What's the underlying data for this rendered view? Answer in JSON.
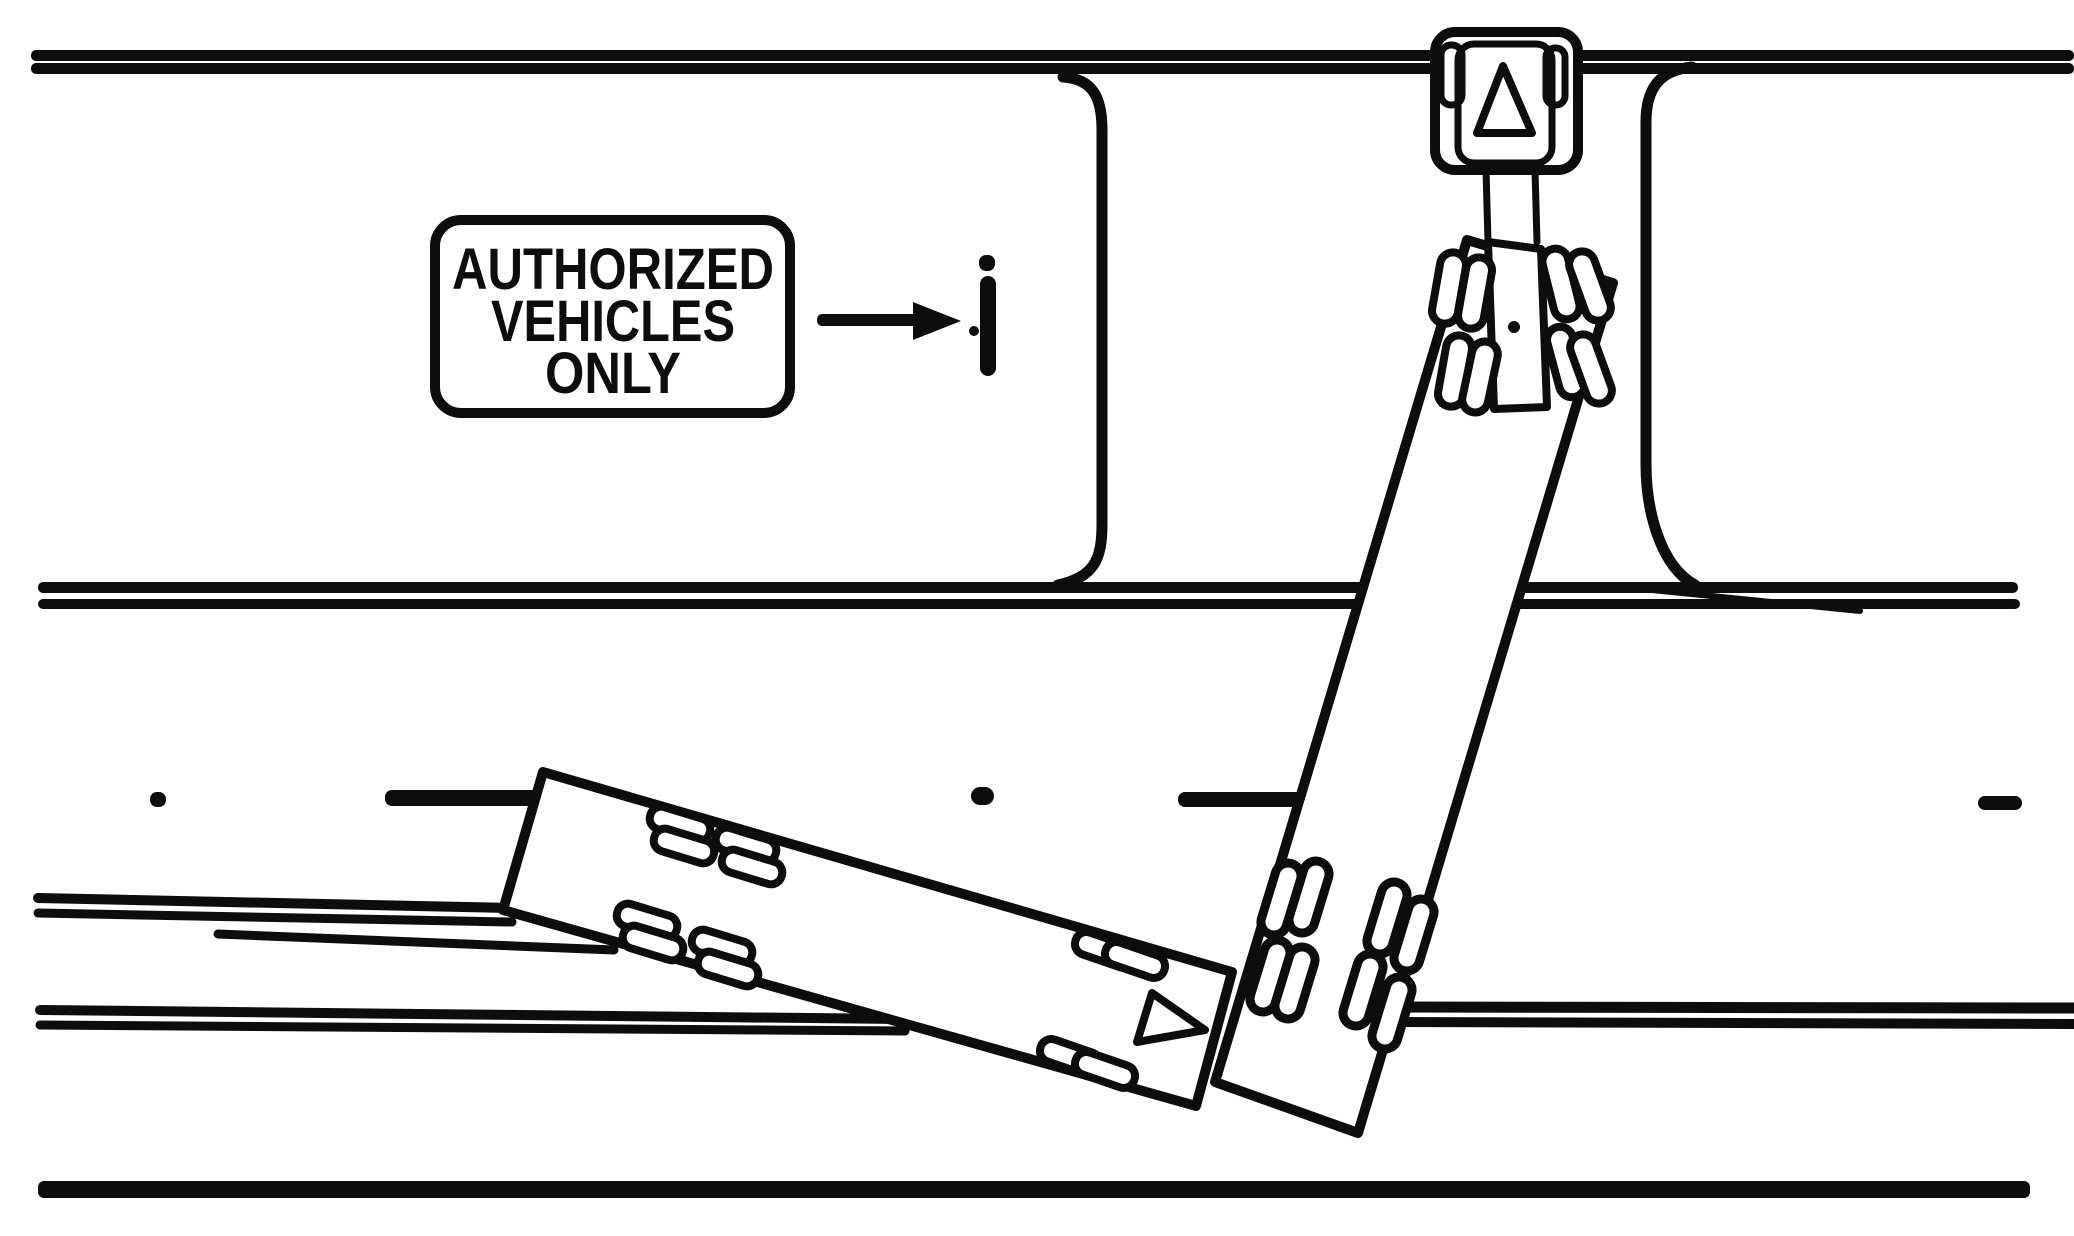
{
  "figure": {
    "sign": {
      "lines": [
        "AUTHORIZED",
        "VEHICLES",
        "ONLY"
      ]
    },
    "colors": {
      "ink": "#0d0d0d",
      "paper": "#ffffff"
    },
    "icons": {
      "cab_direction_marker": "triangle-up",
      "trailer_direction_marker": "triangle-right",
      "sign_pointer": "arrow-right",
      "median_post": "dashed-vertical-bar"
    }
  }
}
